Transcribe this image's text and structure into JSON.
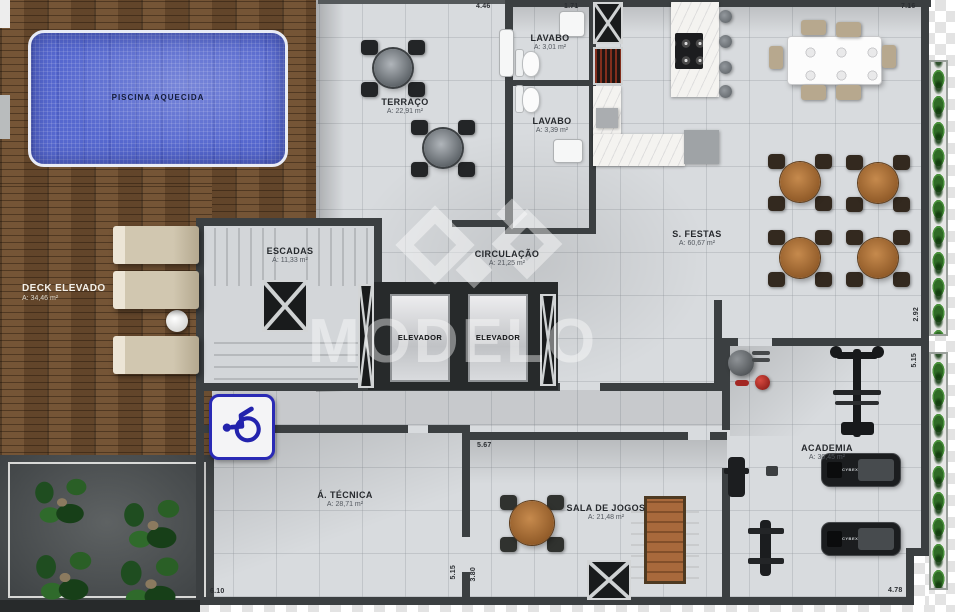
{
  "rooms": {
    "piscina": {
      "name": "PISCINA AQUECIDA"
    },
    "deck": {
      "name": "DECK ELEVADO",
      "area": "A: 34,46 m²"
    },
    "terraco": {
      "name": "TERRAÇO",
      "area": "A: 22,91 m²"
    },
    "lavabo1": {
      "name": "LAVABO",
      "area": "A: 3,01 m²"
    },
    "lavabo2": {
      "name": "LAVABO",
      "area": "A: 3,39 m²"
    },
    "escadas": {
      "name": "ESCADAS",
      "area": "A: 11,33 m²"
    },
    "circulacao": {
      "name": "CIRCULAÇÃO",
      "area": "A: 21,25 m²"
    },
    "sfestas": {
      "name": "S. FESTAS",
      "area": "A: 60,67 m²"
    },
    "elevador": {
      "name": "ELEVADOR"
    },
    "atecnica": {
      "name": "Á. TÉCNICA",
      "area": "A: 28,71 m²"
    },
    "salajogos": {
      "name": "SALA DE JOGOS",
      "area": "A: 21,48 m²"
    },
    "academia": {
      "name": "ACADEMIA",
      "area": "A: 30,45 m²"
    }
  },
  "dimensions": {
    "top_lavabo_width": "4.46",
    "top_shaft_width": "1.71",
    "top_right_width": "7.16",
    "right_sfestas_height": "2.92",
    "right_academia_height": "5.15",
    "bottom_right_width": "4.78",
    "salajogos_top_width": "5.67",
    "atecnica_bottom_width": "6.10",
    "atecnica_right_height": "5.15",
    "salajogos_left_height": "3.80"
  },
  "watermark": {
    "text": "MODELO"
  },
  "equipment": {
    "treadmill_brand": "CYBEX"
  },
  "icons": {
    "accessibility": "wheelchair-icon"
  },
  "colors": {
    "pool": "#5668cf",
    "wood": "#6b4c2f",
    "wall": "#3b3f41",
    "floor": "#d8dbde",
    "hedge_green": "#2f6a25",
    "accessibility_blue": "#2a2ab5"
  }
}
